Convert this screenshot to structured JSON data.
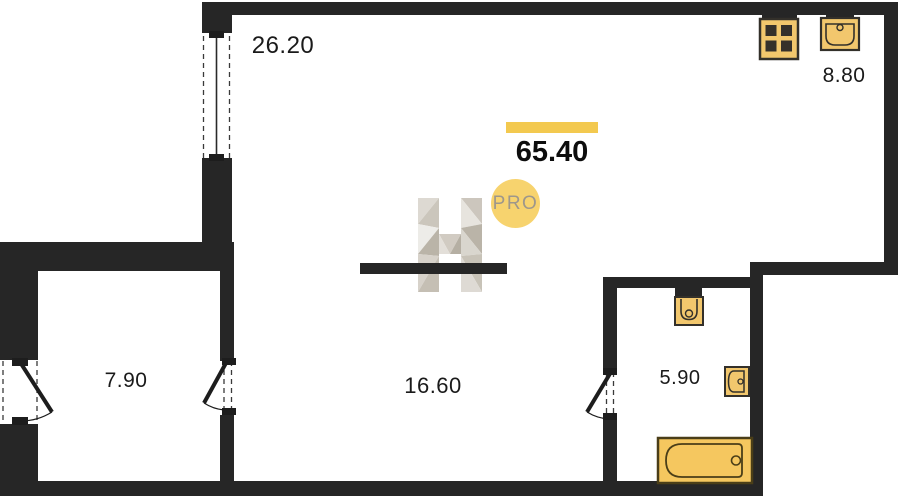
{
  "plan": {
    "total_area": "65.40",
    "badge_label": "PRO",
    "rooms": [
      {
        "name": "living-room",
        "area": "26.20"
      },
      {
        "name": "kitchen",
        "area": "8.80"
      },
      {
        "name": "room",
        "area": "7.90"
      },
      {
        "name": "hallway",
        "area": "16.60"
      },
      {
        "name": "bathroom",
        "area": "5.90"
      }
    ],
    "fixtures": [
      "stove-icon",
      "kitchen-sink-icon",
      "toilet-icon",
      "washbasin-icon",
      "bathtub-icon"
    ],
    "colors": {
      "wall": "#262626",
      "fixture_fill": "#F2C76D",
      "fixture_stroke": "#33302A",
      "accent_bar": "#F3C94F",
      "badge_fill": "#F7D36E",
      "badge_text": "#9E978B"
    }
  }
}
